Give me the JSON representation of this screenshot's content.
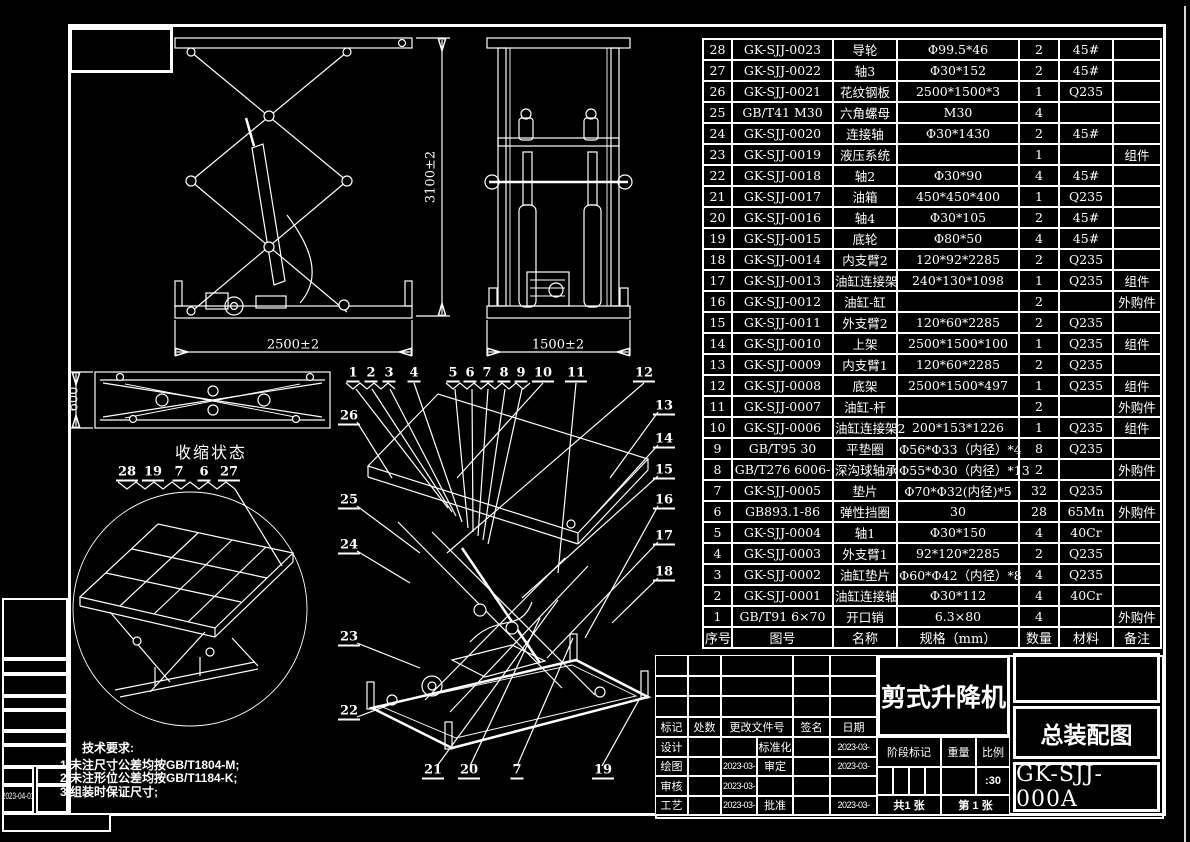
{
  "bom": {
    "headers": [
      "序号",
      "图号",
      "名称",
      "规格（mm）",
      "数量",
      "材料",
      "备注"
    ],
    "rows": [
      [
        "28",
        "GK-SJJ-0023",
        "导轮",
        "Φ99.5*46",
        "2",
        "45#",
        ""
      ],
      [
        "27",
        "GK-SJJ-0022",
        "轴3",
        "Φ30*152",
        "2",
        "45#",
        ""
      ],
      [
        "26",
        "GK-SJJ-0021",
        "花纹钢板",
        "2500*1500*3",
        "1",
        "Q235",
        ""
      ],
      [
        "25",
        "GB/T41 M30",
        "六角螺母",
        "M30",
        "4",
        "",
        ""
      ],
      [
        "24",
        "GK-SJJ-0020",
        "连接轴",
        "Φ30*1430",
        "2",
        "45#",
        ""
      ],
      [
        "23",
        "GK-SJJ-0019",
        "液压系统",
        "",
        "1",
        "",
        "组件"
      ],
      [
        "22",
        "GK-SJJ-0018",
        "轴2",
        "Φ30*90",
        "4",
        "45#",
        ""
      ],
      [
        "21",
        "GK-SJJ-0017",
        "油箱",
        "450*450*400",
        "1",
        "Q235",
        ""
      ],
      [
        "20",
        "GK-SJJ-0016",
        "轴4",
        "Φ30*105",
        "2",
        "45#",
        ""
      ],
      [
        "19",
        "GK-SJJ-0015",
        "底轮",
        "Φ80*50",
        "4",
        "45#",
        ""
      ],
      [
        "18",
        "GK-SJJ-0014",
        "内支臂2",
        "120*92*2285",
        "2",
        "Q235",
        ""
      ],
      [
        "17",
        "GK-SJJ-0013",
        "油缸连接架",
        "240*130*1098",
        "1",
        "Q235",
        "组件"
      ],
      [
        "16",
        "GK-SJJ-0012",
        "油缸-缸",
        "",
        "2",
        "",
        "外购件"
      ],
      [
        "15",
        "GK-SJJ-0011",
        "外支臂2",
        "120*60*2285",
        "2",
        "Q235",
        ""
      ],
      [
        "14",
        "GK-SJJ-0010",
        "上架",
        "2500*1500*100",
        "1",
        "Q235",
        "组件"
      ],
      [
        "13",
        "GK-SJJ-0009",
        "内支臂1",
        "120*60*2285",
        "2",
        "Q235",
        ""
      ],
      [
        "12",
        "GK-SJJ-0008",
        "底架",
        "2500*1500*497",
        "1",
        "Q235",
        "组件"
      ],
      [
        "11",
        "GK-SJJ-0007",
        "油缸-杆",
        "",
        "2",
        "",
        "外购件"
      ],
      [
        "10",
        "GK-SJJ-0006",
        "油缸连接架2",
        "200*153*1226",
        "1",
        "Q235",
        "组件"
      ],
      [
        "9",
        "GB/T95 30",
        "平垫圈",
        "Φ56*Φ33（内径）*4",
        "8",
        "Q235",
        ""
      ],
      [
        "8",
        "GB/T276 6006-",
        "深沟球轴承",
        "Φ55*Φ30（内径）*13",
        "2",
        "",
        "外购件"
      ],
      [
        "7",
        "GK-SJJ-0005",
        "垫片",
        "Φ70*Φ32(内径)*5",
        "32",
        "Q235",
        ""
      ],
      [
        "6",
        "GB893.1-86",
        "弹性挡圈",
        "30",
        "28",
        "65Mn",
        "外购件"
      ],
      [
        "5",
        "GK-SJJ-0004",
        "轴1",
        "Φ30*150",
        "4",
        "40Cr",
        ""
      ],
      [
        "4",
        "GK-SJJ-0003",
        "外支臂1",
        "92*120*2285",
        "2",
        "Q235",
        ""
      ],
      [
        "3",
        "GK-SJJ-0002",
        "油缸垫片",
        "Φ60*Φ42（内径）*8",
        "4",
        "Q235",
        ""
      ],
      [
        "2",
        "GK-SJJ-0001",
        "油缸连接轴",
        "Φ30*112",
        "4",
        "40Cr",
        ""
      ],
      [
        "1",
        "GB/T91 6×70",
        "开口销",
        "6.3×80",
        "4",
        "",
        "外购件"
      ]
    ]
  },
  "views": {
    "front": {
      "dim_height": "3100±2",
      "dim_width": "2500±2"
    },
    "side": {
      "dim_width": "1500±2"
    },
    "collapsed": {
      "dim_height": "600",
      "label": "收缩状态"
    },
    "detail": {
      "callouts": [
        "28",
        "19",
        "7",
        "6",
        "27"
      ]
    }
  },
  "balloons": {
    "top": [
      "1",
      "2",
      "3",
      "4",
      "5",
      "6",
      "7",
      "8",
      "9",
      "10",
      "11",
      "12"
    ],
    "right": [
      "13",
      "14",
      "15",
      "16",
      "17",
      "18"
    ],
    "left": [
      "26",
      "25",
      "24",
      "23",
      "22"
    ],
    "bottom": [
      "21",
      "20",
      "7",
      "19"
    ]
  },
  "tech_notes": {
    "title": "技术要求:",
    "lines": [
      "1.未注尺寸公差均按GB/T1804-M;",
      "2.未注形位公差均按GB/T1184-K;",
      "3.组装时保证尺寸;"
    ]
  },
  "title_block": {
    "rev_headers": [
      "标记",
      "处数",
      "更改文件号",
      "签名",
      "日期"
    ],
    "sign_rows": [
      {
        "role": "设计",
        "date": "",
        "role2": "标准化",
        "date2": "2023-03-"
      },
      {
        "role": "绘图",
        "date": "2023-03-",
        "role2": "审定",
        "date2": "2023-03-"
      },
      {
        "role": "审核",
        "date": "2023-03-",
        "role2": "",
        "date2": ""
      },
      {
        "role": "工艺",
        "date": "2023-03-",
        "role2": "批准",
        "date2": "2023-03-"
      }
    ],
    "product_title": "剪式升降机",
    "doc_type": "总装配图",
    "drawing_no": "GK-SJJ-000A",
    "stage_label": "阶段标记",
    "weight_label": "重量",
    "scale_label": "比例",
    "scale_value": ":30",
    "sheet_total": "共1 张",
    "sheet_no": "第 1 张"
  },
  "edge": {
    "plot_date": "2023-04-01"
  },
  "colors": {
    "background": "#000000",
    "line": "#ffffff"
  }
}
